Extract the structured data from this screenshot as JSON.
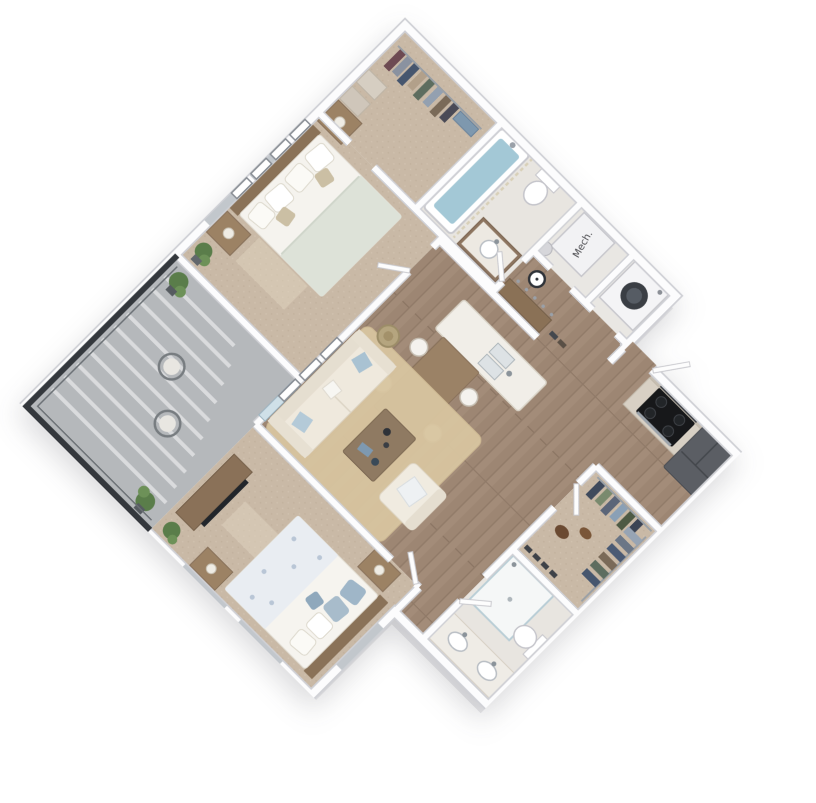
{
  "image": {
    "type": "3d-floorplan-render",
    "style": "isometric top-down, plan rotated 45 degrees on white background",
    "background": "#ffffff"
  },
  "labels": {
    "mech_unit": "Mech."
  },
  "palette": {
    "wall": "#fcfcfd",
    "wall_edge": "#cfd0d5",
    "wood_floor": "#a38c79",
    "carpet": "#c9b9a6",
    "bath_floor": "#e8e5e0",
    "balcony_floor": "#b5b8bb",
    "railing": "#34383d",
    "rug": "#d8c5a0",
    "sofa_cream": "#efe9dd",
    "accent_pillow_blue": "#a9c2d2",
    "tub_water": "#a3c8d6",
    "cooktop_black": "#17181a",
    "fridge_gray": "#5b5e64",
    "cabinet_wood": "#d8d0c4",
    "island_top": "#f1eee8",
    "table_wood": "#9b8266",
    "dresser_wood": "#8a7158",
    "plant_green": "#5a7d4a",
    "duvet_sage": "#dde2d8",
    "duvet_blue": "#e9edf2"
  },
  "rooms": [
    {
      "name": "walk-in-closet-primary",
      "floor": "carpet",
      "furniture": [
        "clothes rod with hanging clothes",
        "storage boxes",
        "folded linens"
      ]
    },
    {
      "name": "bathroom-1",
      "floor": "tile",
      "furniture": [
        "bathtub with water",
        "shower curtain",
        "toilet",
        "vanity with sink"
      ]
    },
    {
      "name": "mechanical-room",
      "floor": "tile",
      "furniture": [
        "mechanical unit labeled Mech.",
        "water heater"
      ]
    },
    {
      "name": "laundry-closet",
      "floor": "tile",
      "furniture": [
        "front-load washer"
      ]
    },
    {
      "name": "entry-hall",
      "floor": "hardwood",
      "furniture": [
        "bench",
        "coat hooks",
        "wall clock",
        "shoes",
        "open front door"
      ]
    },
    {
      "name": "kitchen",
      "floor": "hardwood",
      "furniture": [
        "upper cabinets",
        "base cabinets",
        "cooktop with oven",
        "microwave",
        "refrigerator",
        "island with double sink"
      ]
    },
    {
      "name": "dining-area",
      "floor": "hardwood",
      "furniture": [
        "dining table",
        "four chairs"
      ]
    },
    {
      "name": "living-room",
      "floor": "hardwood",
      "furniture": [
        "sofa with blue pillows",
        "armchair",
        "coffee table",
        "area rug",
        "basket",
        "three wall frames"
      ]
    },
    {
      "name": "primary-bedroom",
      "floor": "carpet",
      "furniture": [
        "queen bed",
        "two nightstands with lamps",
        "four wall frames",
        "potted plant"
      ]
    },
    {
      "name": "walk-in-closet-2",
      "floor": "carpet",
      "furniture": [
        "hanging clothes",
        "shoes",
        "bags"
      ]
    },
    {
      "name": "bathroom-2",
      "floor": "tile",
      "furniture": [
        "walk-in shower",
        "double vanity with two sinks",
        "toilet"
      ]
    },
    {
      "name": "bedroom-2",
      "floor": "carpet",
      "furniture": [
        "bed with floral duvet and blue pillows",
        "two nightstands",
        "dresser with TV",
        "potted plant",
        "sunlight patches"
      ]
    },
    {
      "name": "balcony",
      "floor": "concrete",
      "furniture": [
        "two wire chairs",
        "two potted plants",
        "dark metal railing with shadow stripes"
      ]
    }
  ]
}
